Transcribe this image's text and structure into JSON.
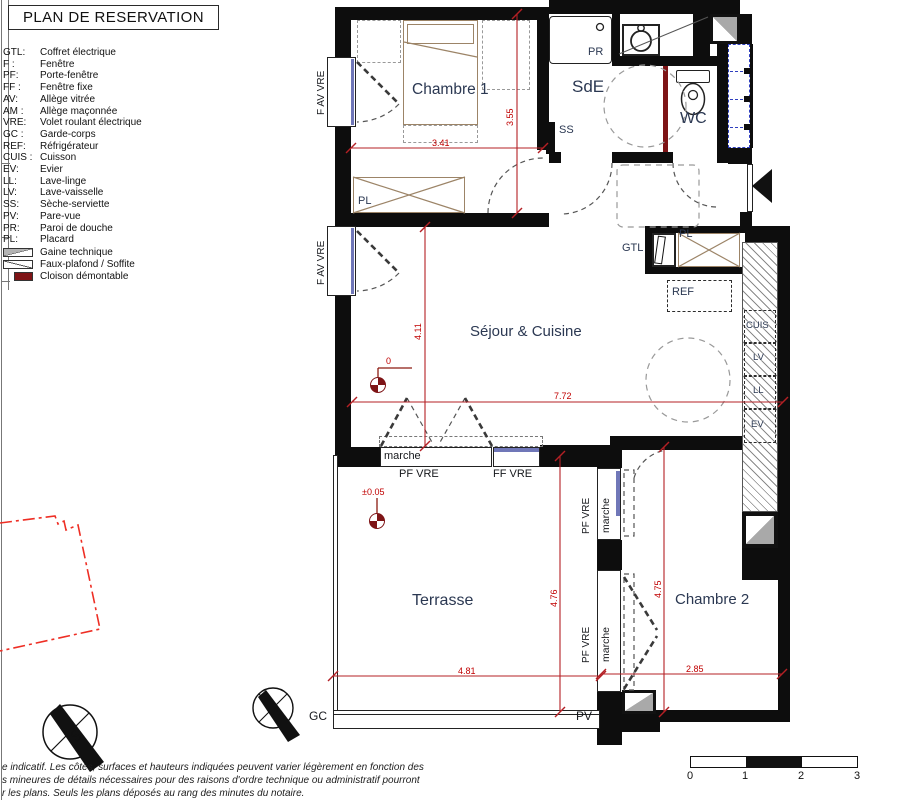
{
  "title": "PLAN DE RESERVATION",
  "legend": {
    "items": [
      {
        "abbr": "GTL:",
        "label": "Coffret électrique"
      },
      {
        "abbr": "F :",
        "label": "Fenêtre"
      },
      {
        "abbr": "PF:",
        "label": "Porte-fenêtre"
      },
      {
        "abbr": "FF :",
        "label": "Fenêtre fixe"
      },
      {
        "abbr": "AV:",
        "label": "Allège vitrée"
      },
      {
        "abbr": "AM :",
        "label": "Allège maçonnée"
      },
      {
        "abbr": "VRE:",
        "label": "Volet roulant électrique"
      },
      {
        "abbr": "GC :",
        "label": "Garde-corps"
      },
      {
        "abbr": "REF:",
        "label": "Réfrigérateur"
      },
      {
        "abbr": "CUIS :",
        "label": "Cuisson"
      },
      {
        "abbr": "EV:",
        "label": "Evier"
      },
      {
        "abbr": "LL:",
        "label": "Lave-linge"
      },
      {
        "abbr": "LV:",
        "label": "Lave-vaisselle"
      },
      {
        "abbr": "SS:",
        "label": "Sèche-serviette"
      },
      {
        "abbr": "PV:",
        "label": "Pare-vue"
      },
      {
        "abbr": "PR:",
        "label": "Paroi de douche"
      },
      {
        "abbr": "PL:",
        "label": "Placard"
      }
    ],
    "symbols": [
      {
        "label": "Gaine technique"
      },
      {
        "label": "Faux-plafond / Soffite"
      },
      {
        "label": "Cloison démontable"
      }
    ]
  },
  "rooms": {
    "chambre1": "Chambre 1",
    "sde": "SdE",
    "wc": "WC",
    "sejour": "Séjour & Cuisine",
    "terrasse": "Terrasse",
    "chambre2": "Chambre 2"
  },
  "annotations": {
    "pr": "PR",
    "ss": "SS",
    "gtl": "GTL",
    "pl": "PL",
    "ref": "REF",
    "cuis": "CUIS",
    "lv": "LV",
    "ll": "LL",
    "ev": "EV",
    "gc": "GC",
    "pv": "PV",
    "marche": "marche",
    "pf_vre": "PF VRE",
    "ff_vre": "FF VRE",
    "f_av_vre": "F AV VRE",
    "south": "S"
  },
  "dimensions": {
    "chambre1_width": "3.41",
    "chambre1_height": "3.55",
    "sejour_height": "4.11",
    "sejour_width": "7.72",
    "terrasse_height": "4.76",
    "terrasse_width": "4.81",
    "chambre2_height": "4.75",
    "chambre2_width": "2.85",
    "level_zero": "0",
    "level_terrasse": "±0.05"
  },
  "scale_bar": {
    "ticks": [
      "0",
      "1",
      "2",
      "3"
    ]
  },
  "disclaimer": {
    "line1": "e indicatif. Les côtes, surfaces et hauteurs indiquées peuvent varier légèrement en fonction des",
    "line2": "s mineures de détails nécessaires pour des raisons d'ordre technique ou administratif pourront",
    "line3": "r les plans. Seuls les plans déposés au rang des minutes du notaire."
  },
  "colors": {
    "dimension": "#c00000",
    "cloison_demontable": "#7e1416",
    "site_outline": "#ee2e24",
    "furniture": "#9c8467",
    "glass": "#7077b8",
    "room_label": "#2b3852"
  }
}
